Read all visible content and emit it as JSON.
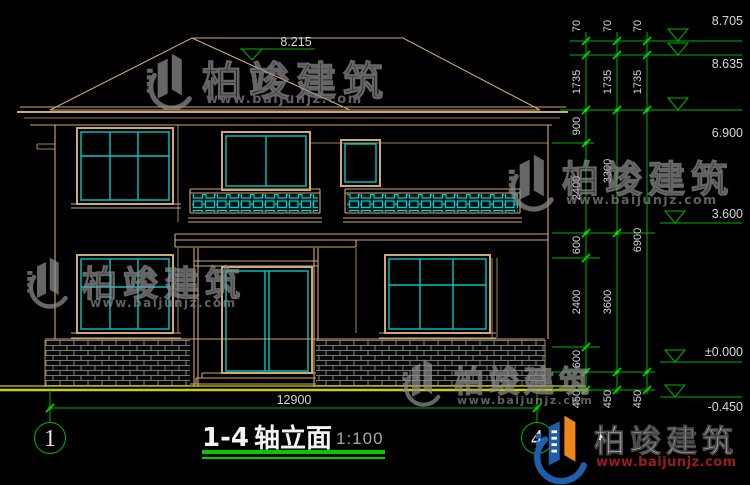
{
  "title_block": {
    "axis_range": "1-4",
    "name": "轴立面",
    "scale": "1:100"
  },
  "axes": {
    "left": "1",
    "right": "4"
  },
  "dimensions": {
    "overall_width": "12900",
    "ridge_level": "8.215",
    "levels": {
      "l1": "8.705",
      "l2": "8.635",
      "l3": "6.900",
      "l4": "3.600",
      "l5": "±0.000",
      "l6": "-0.450"
    },
    "chain_inner": [
      "70",
      "1735",
      "900",
      "2400",
      "600",
      "2400",
      "600",
      "450"
    ],
    "chain_middle": [
      "70",
      "1735",
      "3300",
      "3600",
      "450"
    ],
    "chain_outer": [
      "70",
      "1735",
      "6900",
      "450"
    ]
  },
  "watermark": {
    "brand": "柏竣建筑",
    "url": "www.baijunjz.com"
  },
  "logo": {
    "brand": "柏竣建筑",
    "url": "www.baijunjz.com"
  },
  "colors": {
    "line": "#CFA972",
    "glass": "#00C8C8",
    "dimension": "#00B400",
    "underline": "#00CC00",
    "ground": "#CFCF00",
    "brand_blue": "#1E5FA8",
    "brand_orange": "#F08518",
    "url_red": "#9B1C1C"
  }
}
